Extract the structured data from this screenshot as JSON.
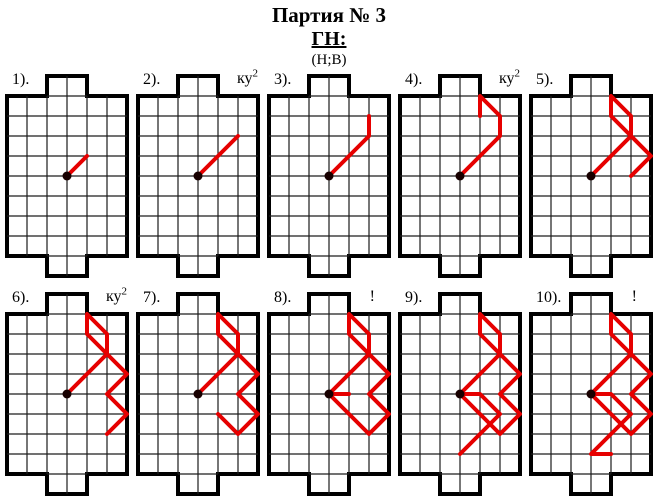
{
  "header": {
    "title": "Партия № 3",
    "game_heading": "ГН:",
    "players": "(Н;В)"
  },
  "colors": {
    "ball_path_red": "#e60000",
    "field_border": "#000000",
    "grid_line": "#1c1c1c",
    "kickoff_dot": "#180000",
    "background": "#ffffff"
  },
  "field": {
    "cols": 6,
    "rows": 8,
    "cell_px": 20,
    "goal_width_cells": 2,
    "goal_depth_cells": 1,
    "goal_start_col": 2,
    "start_dot": [
      3,
      4
    ]
  },
  "ball_path_full": [
    [
      3,
      4
    ],
    [
      4,
      3
    ],
    [
      5,
      2
    ],
    [
      5,
      1
    ],
    [
      4,
      0
    ],
    [
      4,
      1
    ],
    [
      5,
      2
    ],
    [
      6,
      3
    ],
    [
      5,
      4
    ],
    [
      6,
      5
    ],
    [
      5,
      6
    ],
    [
      4,
      5
    ],
    [
      3,
      4
    ],
    [
      4,
      4
    ],
    [
      5,
      5
    ],
    [
      4,
      6
    ],
    [
      3,
      7
    ],
    [
      4,
      7
    ]
  ],
  "boards": [
    {
      "label": "1).",
      "annotation": "",
      "annotation_sup": "",
      "path_points": 2
    },
    {
      "label": "2).",
      "annotation": "ку",
      "annotation_sup": "2",
      "path_points": 3
    },
    {
      "label": "3).",
      "annotation": "",
      "annotation_sup": "",
      "path_points": 4
    },
    {
      "label": "4).",
      "annotation": "ку",
      "annotation_sup": "2",
      "path_points": 6
    },
    {
      "label": "5).",
      "annotation": "",
      "annotation_sup": "",
      "path_points": 9
    },
    {
      "label": "6).",
      "annotation": "ку",
      "annotation_sup": "2",
      "path_points": 11
    },
    {
      "label": "7).",
      "annotation": "",
      "annotation_sup": "",
      "path_points": 12
    },
    {
      "label": "8).",
      "annotation": "!",
      "annotation_sup": "",
      "path_points": 14
    },
    {
      "label": "9).",
      "annotation": "",
      "annotation_sup": "",
      "path_points": 17
    },
    {
      "label": "10).",
      "annotation": "!",
      "annotation_sup": "",
      "path_points": 18
    }
  ]
}
